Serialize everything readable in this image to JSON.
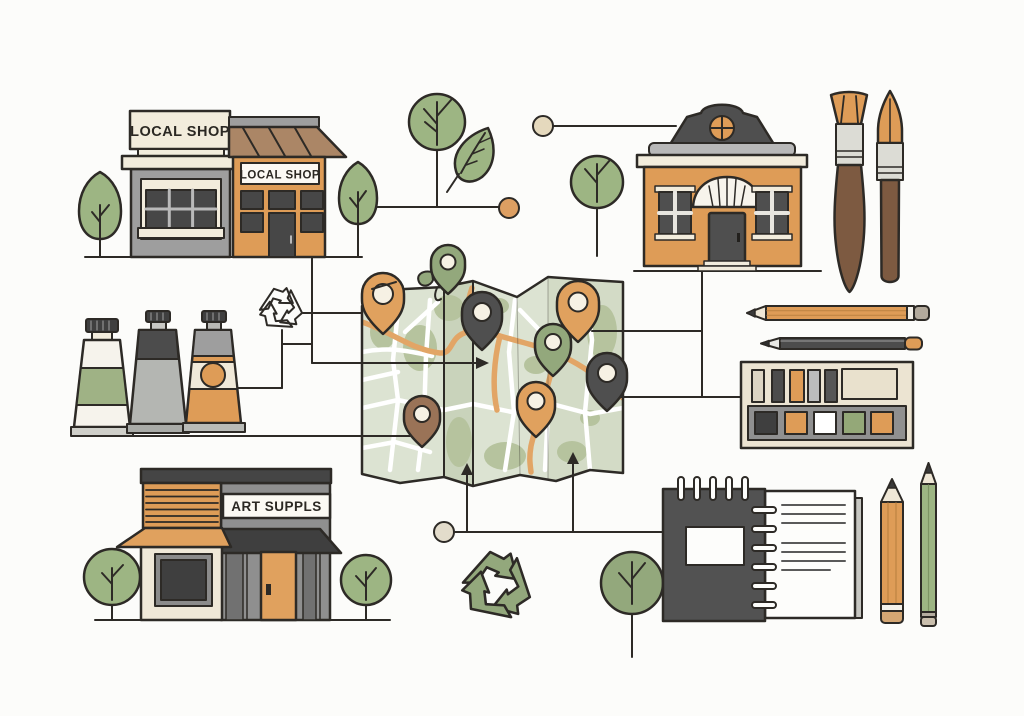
{
  "scene": {
    "background": "#fcfcfa",
    "outline_color": "#2d2a26",
    "description": "Flat illustration of local art-supply shops connected to a folded city map"
  },
  "signs": {
    "gray_shop": "LOCAL SHOP",
    "orange_shop": "LOCAL SHOP",
    "art_shop": "ART SUPPLS"
  },
  "colors": {
    "orange": "#de9c57",
    "awning_orange": "#e0a15e",
    "cream": "#f0e9d9",
    "leaf_green": "#9db583",
    "sage_green": "#93a87c",
    "map_base": "#dce3d2",
    "map_fold_shade": "#c9d3bb",
    "map_patch": "#b6c39e",
    "road_orange": "#e2a566",
    "gray": "#9e9e9e",
    "mid_gray": "#8f8f8f",
    "dark_gray": "#4c4c4c",
    "charcoal": "#3f3f3f",
    "wood_brown": "#7d5a41",
    "roof_tan": "#ab8666",
    "pin_brown": "#9a7357",
    "node_beige": "#e5d9bd",
    "white": "#fdfdfb"
  },
  "map": {
    "pin_colors": [
      "orange",
      "green",
      "dark-gray",
      "orange",
      "green",
      "dark-gray",
      "orange",
      "brown"
    ]
  },
  "items": [
    "gray local shop storefront",
    "orange local shop storefront",
    "boutique house",
    "folded city map with 8 location pins",
    "three paint tubes",
    "flat paintbrush",
    "round paintbrush",
    "two horizontal pencils",
    "paint palette box",
    "spiral sketchbook",
    "two vertical pencils",
    "trees",
    "leaf",
    "outline recycling symbol",
    "green recycling symbol",
    "connector nodes and lines"
  ]
}
